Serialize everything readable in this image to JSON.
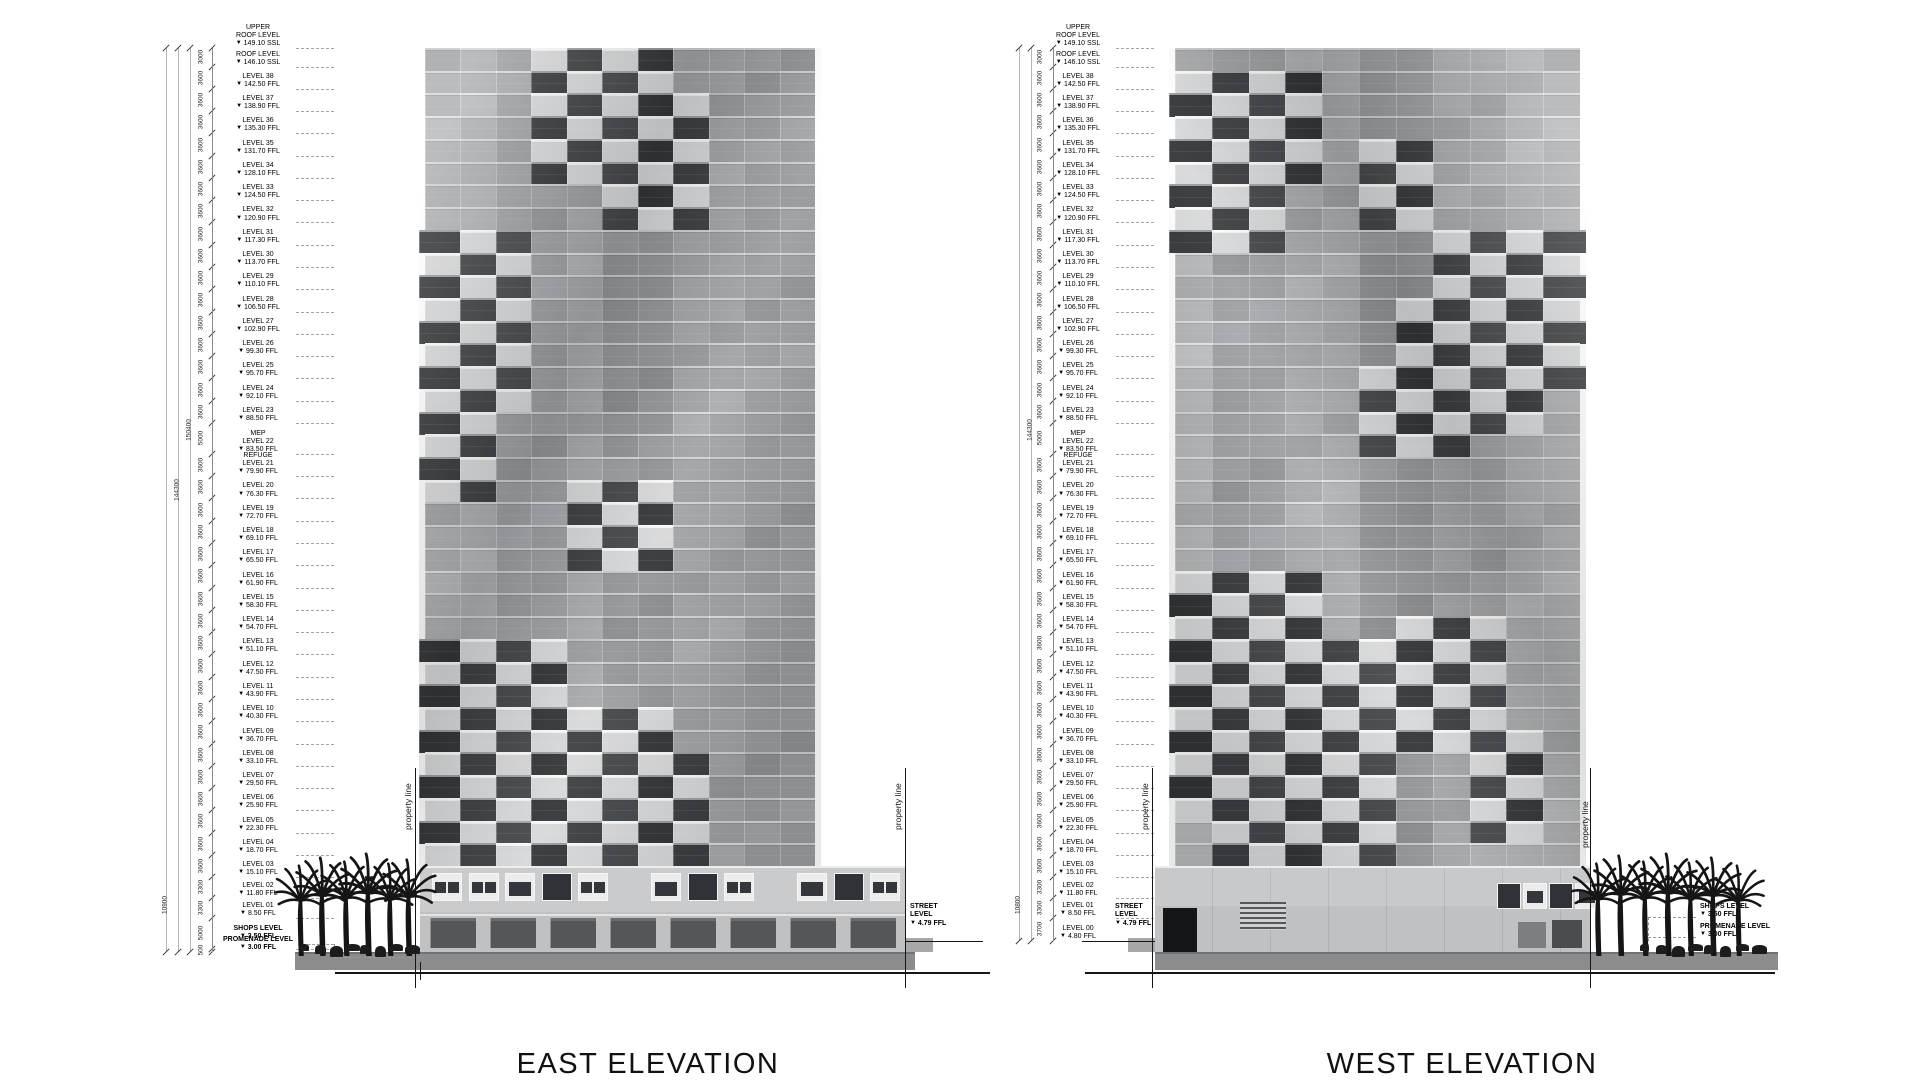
{
  "sheet": {
    "east_title": "EAST ELEVATION",
    "west_title": "WEST ELEVATION"
  },
  "property_line_label": "property line",
  "ground_labels": {
    "promenade": "promenade",
    "podium": "podium"
  },
  "street_level": {
    "name": "STREET LEVEL",
    "value": "4.79 FFL"
  },
  "side_levels": {
    "shops": {
      "name": "SHOPS LEVEL",
      "value": "3.50 FFL"
    },
    "promenade": {
      "name": "PROMENADE LEVEL",
      "value": "3.00 FFL"
    }
  },
  "levels_top": [
    {
      "pre": "UPPER",
      "name": "ROOF LEVEL",
      "value": "149.10 SSL"
    },
    {
      "name": "ROOF LEVEL",
      "value": "146.10 SSL",
      "dim": "3000"
    },
    {
      "name": "LEVEL 38",
      "value": "142.50 FFL",
      "dim": "3600"
    },
    {
      "name": "LEVEL 37",
      "value": "138.90 FFL",
      "dim": "3600"
    },
    {
      "name": "LEVEL 36",
      "value": "135.30 FFL",
      "dim": "3600"
    },
    {
      "name": "LEVEL 35",
      "value": "131.70 FFL",
      "dim": "3600"
    },
    {
      "name": "LEVEL 34",
      "value": "128.10 FFL",
      "dim": "3600"
    },
    {
      "name": "LEVEL 33",
      "value": "124.50 FFL",
      "dim": "3600"
    },
    {
      "name": "LEVEL 32",
      "value": "120.90 FFL",
      "dim": "3600"
    },
    {
      "name": "LEVEL 31",
      "value": "117.30 FFL",
      "dim": "3600"
    },
    {
      "name": "LEVEL 30",
      "value": "113.70 FFL",
      "dim": "3600"
    },
    {
      "name": "LEVEL 29",
      "value": "110.10 FFL",
      "dim": "3600"
    },
    {
      "name": "LEVEL 28",
      "value": "106.50 FFL",
      "dim": "3600"
    },
    {
      "name": "LEVEL 27",
      "value": "102.90 FFL",
      "dim": "3600"
    },
    {
      "name": "LEVEL 26",
      "value": "99.30 FFL",
      "dim": "3600"
    },
    {
      "name": "LEVEL 25",
      "value": "95.70 FFL",
      "dim": "3600"
    },
    {
      "name": "LEVEL 24",
      "value": "92.10 FFL",
      "dim": "3600"
    },
    {
      "name": "LEVEL 23",
      "value": "88.50 FFL",
      "dim": "3600"
    },
    {
      "pre": "MEP",
      "name": "LEVEL 22",
      "value": "83.50 FFL",
      "dim": "5000"
    },
    {
      "pre": "REFUGE",
      "name": "LEVEL 21",
      "value": "79.90 FFL",
      "dim": "3600"
    },
    {
      "name": "LEVEL 20",
      "value": "76.30 FFL",
      "dim": "3600"
    },
    {
      "name": "LEVEL 19",
      "value": "72.70 FFL",
      "dim": "3600"
    },
    {
      "name": "LEVEL 18",
      "value": "69.10 FFL",
      "dim": "3600"
    },
    {
      "name": "LEVEL 17",
      "value": "65.50 FFL",
      "dim": "3600"
    },
    {
      "name": "LEVEL 16",
      "value": "61.90 FFL",
      "dim": "3600"
    },
    {
      "name": "LEVEL 15",
      "value": "58.30 FFL",
      "dim": "3600"
    },
    {
      "name": "LEVEL 14",
      "value": "54.70 FFL",
      "dim": "3600"
    },
    {
      "name": "LEVEL 13",
      "value": "51.10 FFL",
      "dim": "3600"
    },
    {
      "name": "LEVEL 12",
      "value": "47.50 FFL",
      "dim": "3600"
    },
    {
      "name": "LEVEL 11",
      "value": "43.90 FFL",
      "dim": "3600"
    },
    {
      "name": "LEVEL 10",
      "value": "40.30 FFL",
      "dim": "3600"
    },
    {
      "name": "LEVEL 09",
      "value": "36.70 FFL",
      "dim": "3600"
    },
    {
      "name": "LEVEL 08",
      "value": "33.10 FFL",
      "dim": "3600"
    },
    {
      "name": "LEVEL 07",
      "value": "29.50 FFL",
      "dim": "3600"
    },
    {
      "name": "LEVEL 06",
      "value": "25.90 FFL",
      "dim": "3600"
    },
    {
      "name": "LEVEL 05",
      "value": "22.30 FFL",
      "dim": "3600"
    },
    {
      "name": "LEVEL 04",
      "value": "18.70 FFL",
      "dim": "3600"
    },
    {
      "name": "LEVEL 03",
      "value": "15.10 FFL",
      "dim": "3600"
    },
    {
      "name": "LEVEL 02",
      "value": "11.80 FFL",
      "dim": "3300"
    },
    {
      "name": "LEVEL 01",
      "value": "8.50 FFL",
      "dim": "3300"
    }
  ],
  "east_tail": [
    {
      "name": "SHOPS LEVEL",
      "value": "3.50 FFL",
      "dim": "5000",
      "bold": true
    },
    {
      "name": "PROMENADE LEVEL",
      "value": "3.00 FFL",
      "dim": "500",
      "bold": true
    }
  ],
  "west_tail": [
    {
      "name": "LEVEL 00",
      "value": "4.80 FFL",
      "dim": "3700"
    }
  ],
  "outer_dims": {
    "east": [
      "150400",
      "144300",
      "10900"
    ],
    "west": [
      "144300",
      "10800"
    ]
  },
  "colors": {
    "facade_dark_window": "#2b2e31",
    "facade_light_balcony": "#d6d7d8",
    "ground": "#8a8c8e",
    "street": "#a6a8aa",
    "podium_upper": "#cacbcc",
    "podium_lower": "#c0c1c2",
    "podium_west": "#c8c9ca",
    "storefront_glass": "#54575a",
    "tree": "#151515",
    "line": "#161616"
  },
  "facade_pattern": {
    "east_strips": [
      [
        0,
        1,
        "#a9abad"
      ],
      [
        2,
        3,
        "#9a9da0"
      ],
      [
        4,
        4,
        "#a4a6a8"
      ],
      [
        5,
        6,
        "#8f9295"
      ],
      [
        7,
        8,
        "#9da0a2"
      ],
      [
        9,
        10,
        "#979a9c"
      ]
    ],
    "west_strips": [
      [
        0,
        0,
        "#b1b3b5"
      ],
      [
        1,
        2,
        "#9a9da0"
      ],
      [
        3,
        4,
        "#a5a7a9"
      ],
      [
        5,
        6,
        "#8f9295"
      ],
      [
        7,
        8,
        "#9ea1a3"
      ],
      [
        9,
        10,
        "#a9abad"
      ]
    ],
    "east_clusters": [
      {
        "c0": 3,
        "c1": 6,
        "r0": 0,
        "r1": 5
      },
      {
        "c0": 5,
        "c1": 7,
        "r0": 2,
        "r1": 7
      },
      {
        "c0": 0,
        "c1": 2,
        "r0": 8,
        "r1": 13
      },
      {
        "c0": 1,
        "c1": 2,
        "r0": 11,
        "r1": 15
      },
      {
        "c0": 0,
        "c1": 1,
        "r0": 13,
        "r1": 19
      },
      {
        "c0": 4,
        "c1": 6,
        "r0": 19,
        "r1": 22
      },
      {
        "c0": 0,
        "c1": 3,
        "r0": 26,
        "r1": 35
      },
      {
        "c0": 2,
        "c1": 6,
        "r0": 29,
        "r1": 35
      },
      {
        "c0": 5,
        "c1": 7,
        "r0": 31,
        "r1": 35
      }
    ],
    "west_clusters": [
      {
        "c0": 0,
        "c1": 3,
        "r0": 1,
        "r1": 5
      },
      {
        "c0": 0,
        "c1": 2,
        "r0": 4,
        "r1": 8
      },
      {
        "c0": 5,
        "c1": 6,
        "r0": 4,
        "r1": 7
      },
      {
        "c0": 7,
        "c1": 10,
        "r0": 8,
        "r1": 14
      },
      {
        "c0": 6,
        "c1": 9,
        "r0": 11,
        "r1": 16
      },
      {
        "c0": 5,
        "c1": 7,
        "r0": 14,
        "r1": 17
      },
      {
        "c0": 0,
        "c1": 3,
        "r0": 23,
        "r1": 33
      },
      {
        "c0": 1,
        "c1": 5,
        "r0": 26,
        "r1": 35
      },
      {
        "c0": 6,
        "c1": 8,
        "r0": 25,
        "r1": 30
      },
      {
        "c0": 8,
        "c1": 9,
        "r0": 30,
        "r1": 34
      }
    ]
  }
}
